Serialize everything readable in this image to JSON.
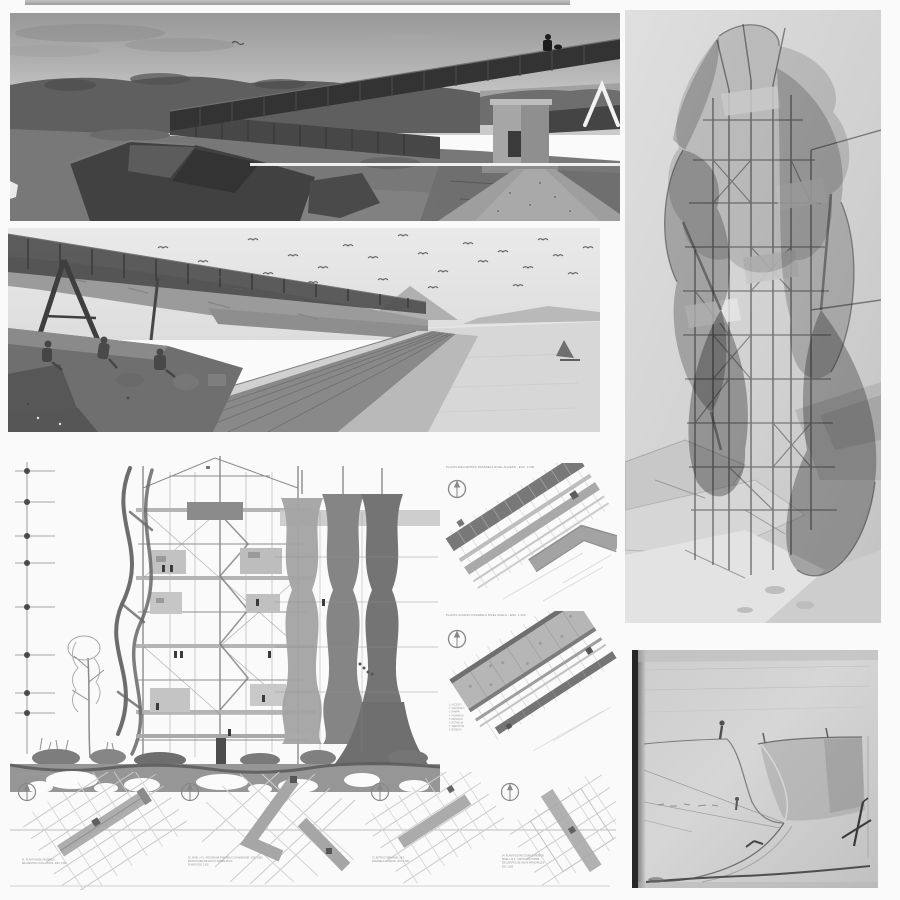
{
  "colors": {
    "paper": "#fafafa",
    "ink": "#3f3f3f",
    "line": "#9a9a9a"
  },
  "section": {
    "scale_note": "ESCALA GRAFICA 1 : 100"
  },
  "plan1": {
    "title": "PLANTA ENCUENTRO PASARELA NIVEL ACCESO - ESC. 1:200"
  },
  "plan2": {
    "title": "PLANTA ACCESO PASARELA NIVEL SUELO - ESC. 1:200",
    "legend": [
      "1. ACCESO",
      "2. VESTIBULO",
      "3. RAMPA",
      "4. PASARELA",
      "5. MIRADOR",
      "6. ESTANCIA",
      "7. SERVICIOS",
      "8. BODEGA"
    ]
  },
  "captions": {
    "c1": [
      "01. PLANTA NIVEL PASARELA",
      "ENCUENTRO CON LA ROCA - ESC 1:500"
    ],
    "c2": [
      "02. NIVEL +4.5 - PROGRAMA PASARELA CON MIRADOR - ESC 1:500",
      "ESTRUCTURA DE APOYO SOBRE ROCA",
      "PLANTA ESC 1:500"
    ],
    "c3": [
      "03. ESTRUCTURA NIVEL +9.0",
      "PASARELA MIRADOR - ESC 1:500"
    ],
    "c4": [
      "04. PLANTA ESTRUCTURA SUPERIOR",
      "NIVEL +13.5 - UNION CON TORRE",
      "ENCUENTRO DE VIGAS PRINCIPALES",
      "ESC 1:500"
    ]
  }
}
